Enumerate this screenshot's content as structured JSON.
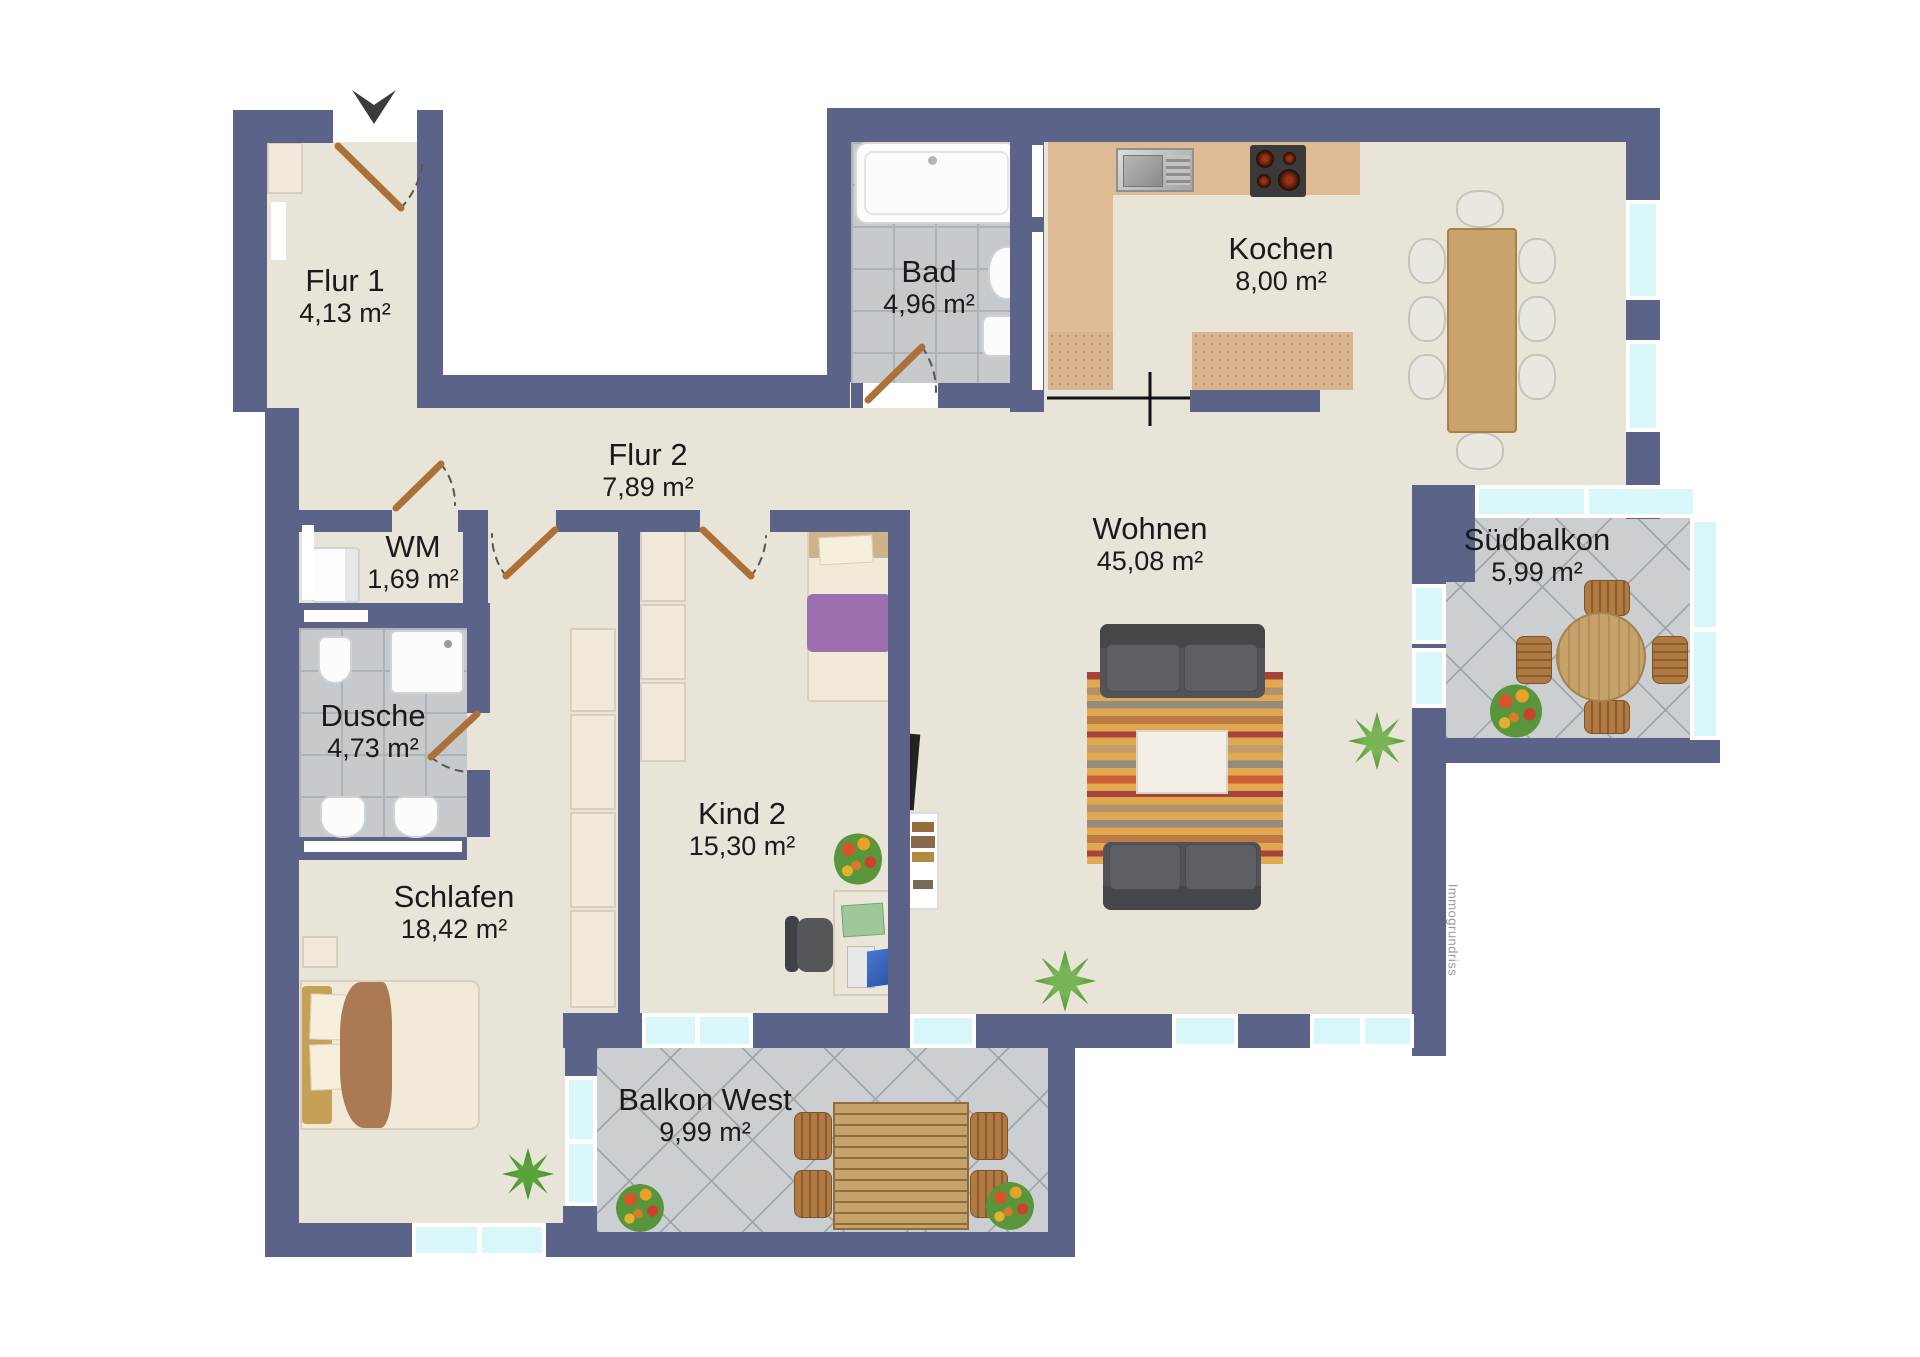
{
  "plan": {
    "type": "apartment-floorplan",
    "watermark": "Immogrundriss",
    "rooms": [
      {
        "id": "flur-1",
        "name": "Flur 1",
        "area": "4,13 m²"
      },
      {
        "id": "bad",
        "name": "Bad",
        "area": "4,96 m²"
      },
      {
        "id": "kochen",
        "name": "Kochen",
        "area": "8,00 m²"
      },
      {
        "id": "flur-2",
        "name": "Flur 2",
        "area": "7,89 m²"
      },
      {
        "id": "wm",
        "name": "WM",
        "area": "1,69 m²"
      },
      {
        "id": "dusche",
        "name": "Dusche",
        "area": "4,73 m²"
      },
      {
        "id": "wohnen",
        "name": "Wohnen",
        "area": "45,08 m²"
      },
      {
        "id": "suedbalkon",
        "name": "Südbalkon",
        "area": "5,99 m²"
      },
      {
        "id": "kind-2",
        "name": "Kind 2",
        "area": "15,30 m²"
      },
      {
        "id": "schlafen",
        "name": "Schlafen",
        "area": "18,42 m²"
      },
      {
        "id": "balkon-west",
        "name": "Balkon West",
        "area": "9,99 m²"
      }
    ],
    "colors": {
      "wall": "#5b6488",
      "floor": "#e8e4d7",
      "bath_tile": "#c6cacd",
      "balcony_tile": "#cbcfd2",
      "window_glass": "#d9f6f9",
      "door_leaf": "#ad7037",
      "kitchen_counter": "#debb95",
      "label_text": "#1a1a1a"
    }
  }
}
